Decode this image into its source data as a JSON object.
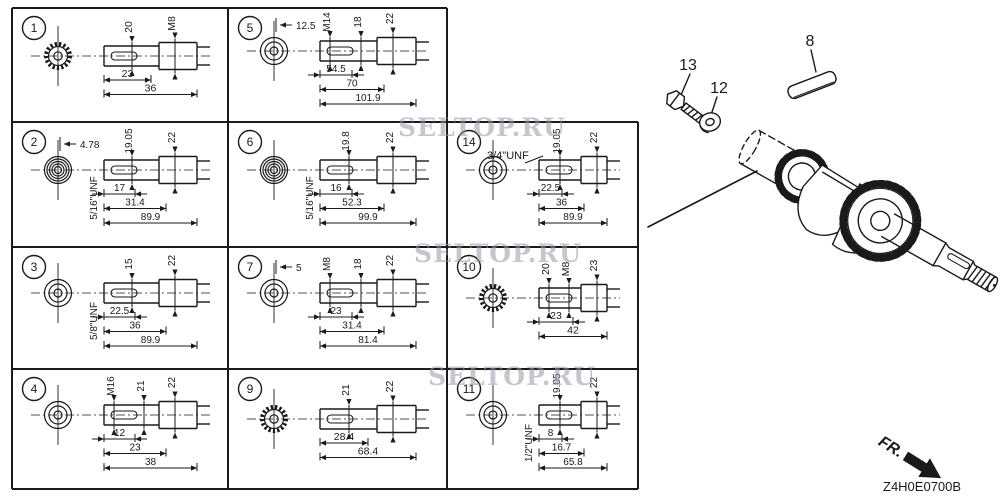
{
  "colors": {
    "line": "#1a1a1a",
    "watermark": "#9699a8",
    "background": "#ffffff"
  },
  "watermark": {
    "text": "SELTOP.RU"
  },
  "footer": {
    "diagram_code": "Z4H0E0700B",
    "fr_label": "FR."
  },
  "right_panel": {
    "part_labels": [
      "13",
      "12",
      "8"
    ]
  },
  "grid": {
    "cells": [
      {
        "number": "1",
        "col": 0,
        "row": 0,
        "end_view": "spline",
        "rotated_labels": [
          "20",
          "M8"
        ],
        "unf_label": null,
        "unf_label_horizontal": null,
        "end_view_dim": null,
        "bottom_dims": [
          "23",
          "36"
        ]
      },
      {
        "number": "5",
        "col": 1,
        "row": 0,
        "end_view": "rings",
        "rotated_labels": [
          "M14",
          "18",
          "22"
        ],
        "unf_label": null,
        "unf_label_horizontal": null,
        "end_view_dim": "12.5",
        "bottom_dims": [
          "54.5",
          "70",
          "101.9"
        ]
      },
      {
        "number": "2",
        "col": 0,
        "row": 1,
        "end_view": "threads",
        "rotated_labels": [
          "19.05",
          "22"
        ],
        "unf_label": "5/16\"UNF",
        "unf_label_horizontal": null,
        "end_view_dim": "4.78",
        "bottom_dims": [
          "17",
          "31.4",
          "89.9"
        ]
      },
      {
        "number": "6",
        "col": 1,
        "row": 1,
        "end_view": "threads",
        "rotated_labels": [
          "19.8",
          "22"
        ],
        "unf_label": "5/16\"UNF",
        "unf_label_horizontal": null,
        "end_view_dim": null,
        "bottom_dims": [
          "16",
          "52.3",
          "99.9"
        ]
      },
      {
        "number": "14",
        "col": 2,
        "row": 1,
        "end_view": "rings",
        "rotated_labels": [
          "19.05",
          "22"
        ],
        "unf_label": null,
        "unf_label_horizontal": "3/4\"UNF",
        "end_view_dim": null,
        "bottom_dims": [
          "22.5",
          "36",
          "89.9"
        ]
      },
      {
        "number": "3",
        "col": 0,
        "row": 2,
        "end_view": "rings",
        "rotated_labels": [
          "15",
          "22"
        ],
        "unf_label": "5/8\"UNF",
        "unf_label_horizontal": null,
        "end_view_dim": null,
        "bottom_dims": [
          "22.5",
          "36",
          "89.9"
        ]
      },
      {
        "number": "7",
        "col": 1,
        "row": 2,
        "end_view": "rings",
        "rotated_labels": [
          "M8",
          "18",
          "22"
        ],
        "unf_label": null,
        "unf_label_horizontal": null,
        "end_view_dim": "5",
        "bottom_dims": [
          "23",
          "31.4",
          "81.4"
        ]
      },
      {
        "number": "10",
        "col": 2,
        "row": 2,
        "end_view": "spline",
        "rotated_labels": [
          "20",
          "M8",
          "23"
        ],
        "unf_label": null,
        "unf_label_horizontal": null,
        "end_view_dim": null,
        "bottom_dims": [
          "23",
          "42"
        ]
      },
      {
        "number": "4",
        "col": 0,
        "row": 3,
        "end_view": "rings",
        "rotated_labels": [
          "M16",
          "21",
          "22"
        ],
        "unf_label": null,
        "unf_label_horizontal": null,
        "end_view_dim": null,
        "bottom_dims": [
          "12",
          "23",
          "38"
        ]
      },
      {
        "number": "9",
        "col": 1,
        "row": 3,
        "end_view": "spline",
        "rotated_labels": [
          "21",
          "22"
        ],
        "unf_label": null,
        "unf_label_horizontal": null,
        "end_view_dim": null,
        "bottom_dims": [
          "28.4",
          "68.4"
        ]
      },
      {
        "number": "11",
        "col": 2,
        "row": 3,
        "end_view": "rings",
        "rotated_labels": [
          "19.05",
          "22"
        ],
        "unf_label": "1/2\"UNF",
        "unf_label_horizontal": null,
        "end_view_dim": null,
        "bottom_dims": [
          "8",
          "16.7",
          "65.8"
        ]
      }
    ]
  }
}
